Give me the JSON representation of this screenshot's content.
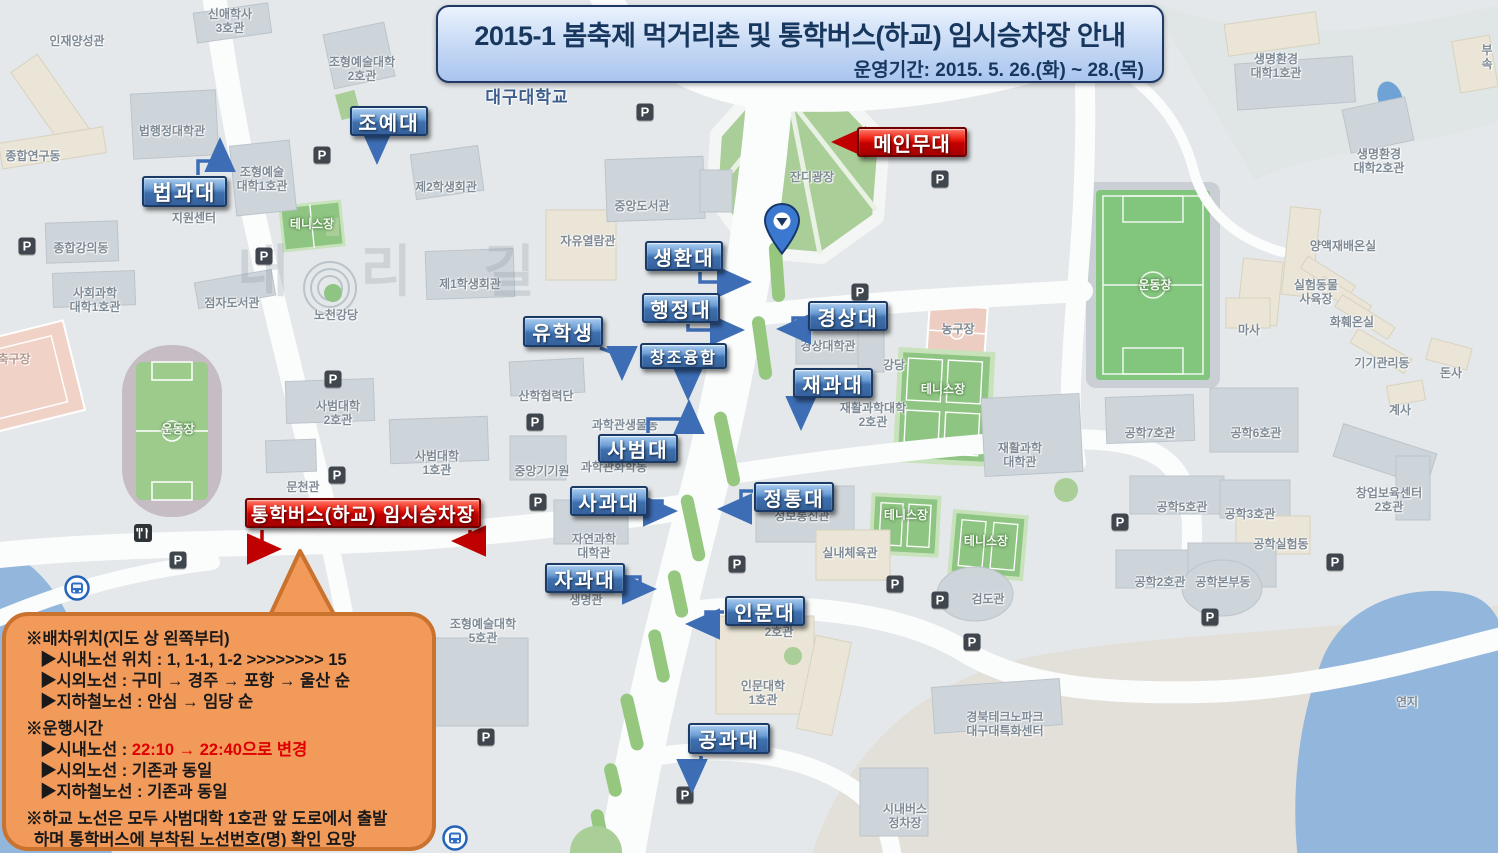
{
  "banner": {
    "title": "2015-1 봄축제 먹거리촌 및 통학버스(하교) 임시승차장 안내",
    "period": "운영기간: 2015. 5. 26.(화) ~ 28.(목)"
  },
  "colors": {
    "label_blue": "#3E70AF",
    "label_red": "#C40000",
    "bubble_orange": "#F29A5A",
    "bubble_border": "#C9732F",
    "banner_navy": "#17375E",
    "map_green": "#9CCB8B",
    "water_blue": "#93B7DC"
  },
  "labels": {
    "college": [
      {
        "text": "조예대",
        "x": 350,
        "y": 106,
        "w": 78,
        "h": 30,
        "fs": 20
      },
      {
        "text": "법과대",
        "x": 142,
        "y": 176,
        "w": 85,
        "h": 31,
        "fs": 21
      },
      {
        "text": "생환대",
        "x": 645,
        "y": 241,
        "w": 78,
        "h": 30,
        "fs": 20
      },
      {
        "text": "행정대",
        "x": 642,
        "y": 293,
        "w": 78,
        "h": 30,
        "fs": 20
      },
      {
        "text": "유학생",
        "x": 523,
        "y": 316,
        "w": 80,
        "h": 31,
        "fs": 20
      },
      {
        "text": "경상대",
        "x": 808,
        "y": 301,
        "w": 80,
        "h": 30,
        "fs": 20
      },
      {
        "text": "창조융합",
        "x": 640,
        "y": 343,
        "w": 87,
        "h": 26,
        "fs": 16
      },
      {
        "text": "재과대",
        "x": 793,
        "y": 368,
        "w": 80,
        "h": 30,
        "fs": 20
      },
      {
        "text": "사범대",
        "x": 598,
        "y": 434,
        "w": 80,
        "h": 29,
        "fs": 20
      },
      {
        "text": "사과대",
        "x": 570,
        "y": 486,
        "w": 78,
        "h": 30,
        "fs": 20
      },
      {
        "text": "정통대",
        "x": 754,
        "y": 482,
        "w": 80,
        "h": 30,
        "fs": 20
      },
      {
        "text": "자과대",
        "x": 545,
        "y": 563,
        "w": 80,
        "h": 30,
        "fs": 20
      },
      {
        "text": "인문대",
        "x": 725,
        "y": 596,
        "w": 80,
        "h": 30,
        "fs": 20
      },
      {
        "text": "공과대",
        "x": 688,
        "y": 723,
        "w": 82,
        "h": 31,
        "fs": 20
      }
    ],
    "red": [
      {
        "text": "메인무대",
        "x": 857,
        "y": 127,
        "w": 110,
        "h": 30,
        "fs": 20
      },
      {
        "text": "통학버스(하교) 임시승차장",
        "x": 245,
        "y": 498,
        "w": 236,
        "h": 30,
        "fs": 19
      }
    ]
  },
  "bubble": {
    "lines": [
      {
        "cls": "head",
        "parts": [
          {
            "t": "※배차위치(지도 상 왼쪽부터)"
          }
        ]
      },
      {
        "cls": "sub",
        "parts": [
          {
            "t": "▶시내노선 위치 : 1, 1-1, 1-2 >>>>>>>> 15"
          }
        ]
      },
      {
        "cls": "sub",
        "parts": [
          {
            "t": "▶시외노선 : 구미 → 경주 → 포항 → 울산 순"
          }
        ]
      },
      {
        "cls": "sub",
        "parts": [
          {
            "t": "▶지하철노선 : 안심 → 임당 순"
          }
        ]
      },
      {
        "cls": "head gap",
        "parts": [
          {
            "t": "※운행시간"
          }
        ]
      },
      {
        "cls": "sub",
        "parts": [
          {
            "t": "▶시내노선 : "
          },
          {
            "t": "22:10 → 22:40으로 변경",
            "red": true
          }
        ]
      },
      {
        "cls": "sub",
        "parts": [
          {
            "t": "▶시외노선 : 기존과 동일"
          }
        ]
      },
      {
        "cls": "sub",
        "parts": [
          {
            "t": "▶지하철노선 : 기존과 동일"
          }
        ]
      },
      {
        "cls": "head gap",
        "parts": [
          {
            "t": "※하교 노선은 모두 사범대학 1호관 앞 도로에서 출발"
          }
        ]
      },
      {
        "cls": "cont",
        "parts": [
          {
            "t": "하며 통학버스에 부착된 노선번호(명) 확인 요망"
          }
        ]
      }
    ]
  },
  "map_labels": [
    {
      "t": "신애학사\n3호관",
      "x": 230,
      "y": 22
    },
    {
      "t": "인재양성관",
      "x": 77,
      "y": 42
    },
    {
      "t": "종합연구동",
      "x": 33,
      "y": 157
    },
    {
      "t": "법행정대학관",
      "x": 172,
      "y": 132
    },
    {
      "t": "조형예술대학\n2호관",
      "x": 362,
      "y": 70
    },
    {
      "t": "대구대학교",
      "x": 527,
      "y": 98,
      "cls": "univ"
    },
    {
      "t": "제2학생회관",
      "x": 446,
      "y": 188
    },
    {
      "t": "조형예술\n대학1호관",
      "x": 262,
      "y": 180
    },
    {
      "t": "지원센터",
      "x": 194,
      "y": 219
    },
    {
      "t": "테니스장",
      "x": 312,
      "y": 225,
      "cls": "field"
    },
    {
      "t": "종합강의동",
      "x": 81,
      "y": 249
    },
    {
      "t": "사회과학\n대학1호관",
      "x": 95,
      "y": 301
    },
    {
      "t": "점자도서관",
      "x": 232,
      "y": 304
    },
    {
      "t": "노천강당",
      "x": 336,
      "y": 316
    },
    {
      "t": "제1학생회관",
      "x": 470,
      "y": 285
    },
    {
      "t": "자유열람관",
      "x": 588,
      "y": 242
    },
    {
      "t": "중앙도서관",
      "x": 642,
      "y": 207
    },
    {
      "t": "잔디광장",
      "x": 812,
      "y": 178
    },
    {
      "t": "내 리 길",
      "x": 400,
      "y": 272,
      "cls": "wm"
    },
    {
      "t": "생명환경\n대학1호관",
      "x": 1276,
      "y": 67
    },
    {
      "t": "부속",
      "x": 1487,
      "y": 58
    },
    {
      "t": "생명환경\n대학2호관",
      "x": 1379,
      "y": 162
    },
    {
      "t": "양액재배온실",
      "x": 1343,
      "y": 247
    },
    {
      "t": "실험동물\n사육장",
      "x": 1316,
      "y": 293
    },
    {
      "t": "마사",
      "x": 1249,
      "y": 331
    },
    {
      "t": "화훼온실",
      "x": 1352,
      "y": 323
    },
    {
      "t": "기기관리동",
      "x": 1382,
      "y": 364
    },
    {
      "t": "돈사",
      "x": 1451,
      "y": 374
    },
    {
      "t": "계사",
      "x": 1400,
      "y": 411
    },
    {
      "t": "운동장",
      "x": 1155,
      "y": 286,
      "cls": "field"
    },
    {
      "t": "운동장",
      "x": 178,
      "y": 430,
      "cls": "field"
    },
    {
      "t": "축구장",
      "x": 14,
      "y": 360,
      "cls": "court"
    },
    {
      "t": "경상대학관",
      "x": 828,
      "y": 347
    },
    {
      "t": "강당",
      "x": 894,
      "y": 366
    },
    {
      "t": "농구장",
      "x": 958,
      "y": 330
    },
    {
      "t": "테니스장",
      "x": 943,
      "y": 390,
      "cls": "field"
    },
    {
      "t": "재활과학대학\n2호관",
      "x": 873,
      "y": 416
    },
    {
      "t": "재활과학\n대학관",
      "x": 1020,
      "y": 456
    },
    {
      "t": "산학협력단",
      "x": 546,
      "y": 397
    },
    {
      "t": "사범대학\n2호관",
      "x": 338,
      "y": 414
    },
    {
      "t": "사범대학\n1호관",
      "x": 437,
      "y": 464
    },
    {
      "t": "문천관",
      "x": 303,
      "y": 488
    },
    {
      "t": "중앙기기원",
      "x": 542,
      "y": 472
    },
    {
      "t": "과학관화학동",
      "x": 614,
      "y": 468
    },
    {
      "t": "과학관생물동",
      "x": 625,
      "y": 426
    },
    {
      "t": "자연과학\n대학관",
      "x": 594,
      "y": 547
    },
    {
      "t": "생명관",
      "x": 586,
      "y": 601
    },
    {
      "t": "정보통신관",
      "x": 802,
      "y": 517
    },
    {
      "t": "실내체육관",
      "x": 850,
      "y": 554
    },
    {
      "t": "검도관",
      "x": 988,
      "y": 600
    },
    {
      "t": "테니스장",
      "x": 906,
      "y": 516,
      "cls": "field"
    },
    {
      "t": "테니스장",
      "x": 986,
      "y": 542,
      "cls": "field"
    },
    {
      "t": "인문대학\n1호관",
      "x": 763,
      "y": 694
    },
    {
      "t": "2호관",
      "x": 779,
      "y": 633
    },
    {
      "t": "경북테크노파크\n대구대특화센터",
      "x": 1005,
      "y": 725
    },
    {
      "t": "시내버스\n정차장",
      "x": 905,
      "y": 817
    },
    {
      "t": "조형예술대학\n5호관",
      "x": 483,
      "y": 632
    },
    {
      "t": "연지",
      "x": 1407,
      "y": 703
    },
    {
      "t": "공학7호관",
      "x": 1150,
      "y": 434
    },
    {
      "t": "공학6호관",
      "x": 1256,
      "y": 434
    },
    {
      "t": "공학5호관",
      "x": 1182,
      "y": 508
    },
    {
      "t": "공학3호관",
      "x": 1250,
      "y": 515
    },
    {
      "t": "창업보육센터\n2호관",
      "x": 1389,
      "y": 501
    },
    {
      "t": "공학실험동",
      "x": 1281,
      "y": 545
    },
    {
      "t": "공학2호관",
      "x": 1160,
      "y": 583
    },
    {
      "t": "공학본부동",
      "x": 1223,
      "y": 583
    }
  ],
  "icons": {
    "parking_glyph": "P",
    "parking_positions": [
      [
        645,
        112
      ],
      [
        940,
        179
      ],
      [
        322,
        155
      ],
      [
        264,
        256
      ],
      [
        27,
        246
      ],
      [
        860,
        292
      ],
      [
        535,
        422
      ],
      [
        333,
        379
      ],
      [
        337,
        475
      ],
      [
        538,
        502
      ],
      [
        737,
        564
      ],
      [
        685,
        795
      ],
      [
        895,
        584
      ],
      [
        940,
        600
      ],
      [
        972,
        642
      ],
      [
        1120,
        522
      ],
      [
        1210,
        617
      ],
      [
        1335,
        562
      ],
      [
        486,
        737
      ],
      [
        178,
        560
      ]
    ],
    "bus_positions": [
      [
        77,
        588
      ],
      [
        455,
        838
      ]
    ],
    "restaurant_position": [
      143,
      533
    ],
    "pin_position": [
      782,
      204
    ]
  }
}
